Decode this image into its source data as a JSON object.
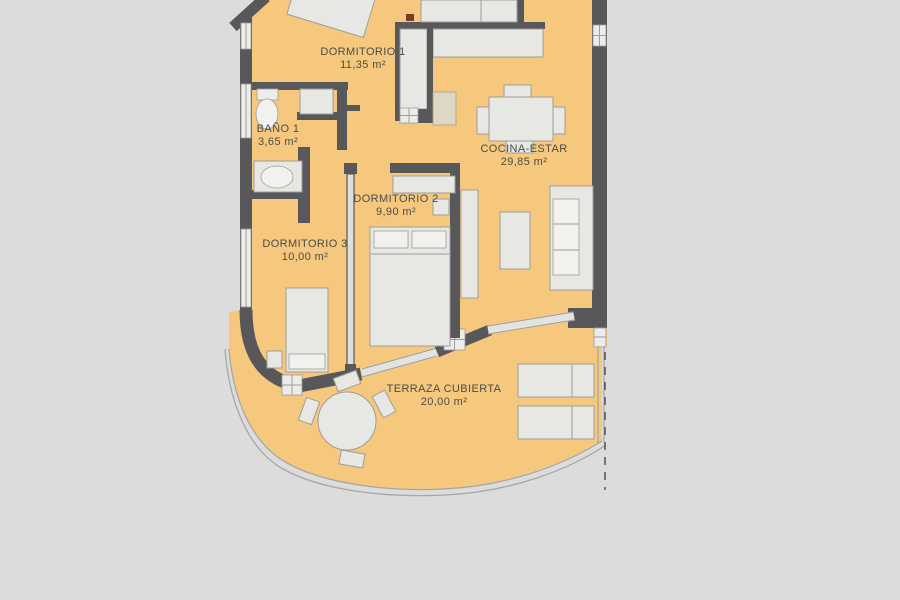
{
  "plan_title": "Apartment floor plan",
  "rooms": [
    {
      "id": "dormitorio-1",
      "name": "DORMITORIO 1",
      "area": "11,35 m²"
    },
    {
      "id": "bano-1",
      "name": "BAÑO 1",
      "area": "3,65 m²"
    },
    {
      "id": "cocina-estar",
      "name": "COCINA-ESTAR",
      "area": "29,85 m²"
    },
    {
      "id": "dormitorio-2",
      "name": "DORMITORIO 2",
      "area": "9,90 m²"
    },
    {
      "id": "dormitorio-3",
      "name": "DORMITORIO 3",
      "area": "10,00 m²"
    },
    {
      "id": "terraza-cubierta",
      "name": "TERRAZA CUBIERTA",
      "area": "20,00 m²"
    }
  ],
  "colors": {
    "background": "#dcdcdc",
    "floor": "#f5c87d",
    "wall": "#58585a",
    "furniture": "#e7e7e4",
    "furniture_light": "#f1f1ee",
    "window": "#ecedea",
    "glass": "#e3e3df",
    "outline": "#9d9d9a",
    "railing": "#a7a7a4",
    "appliance": "#ddd7c4",
    "accent_red": "#7d3a2c",
    "dash": "#4a4a4a",
    "text": "#4b4b4b"
  }
}
